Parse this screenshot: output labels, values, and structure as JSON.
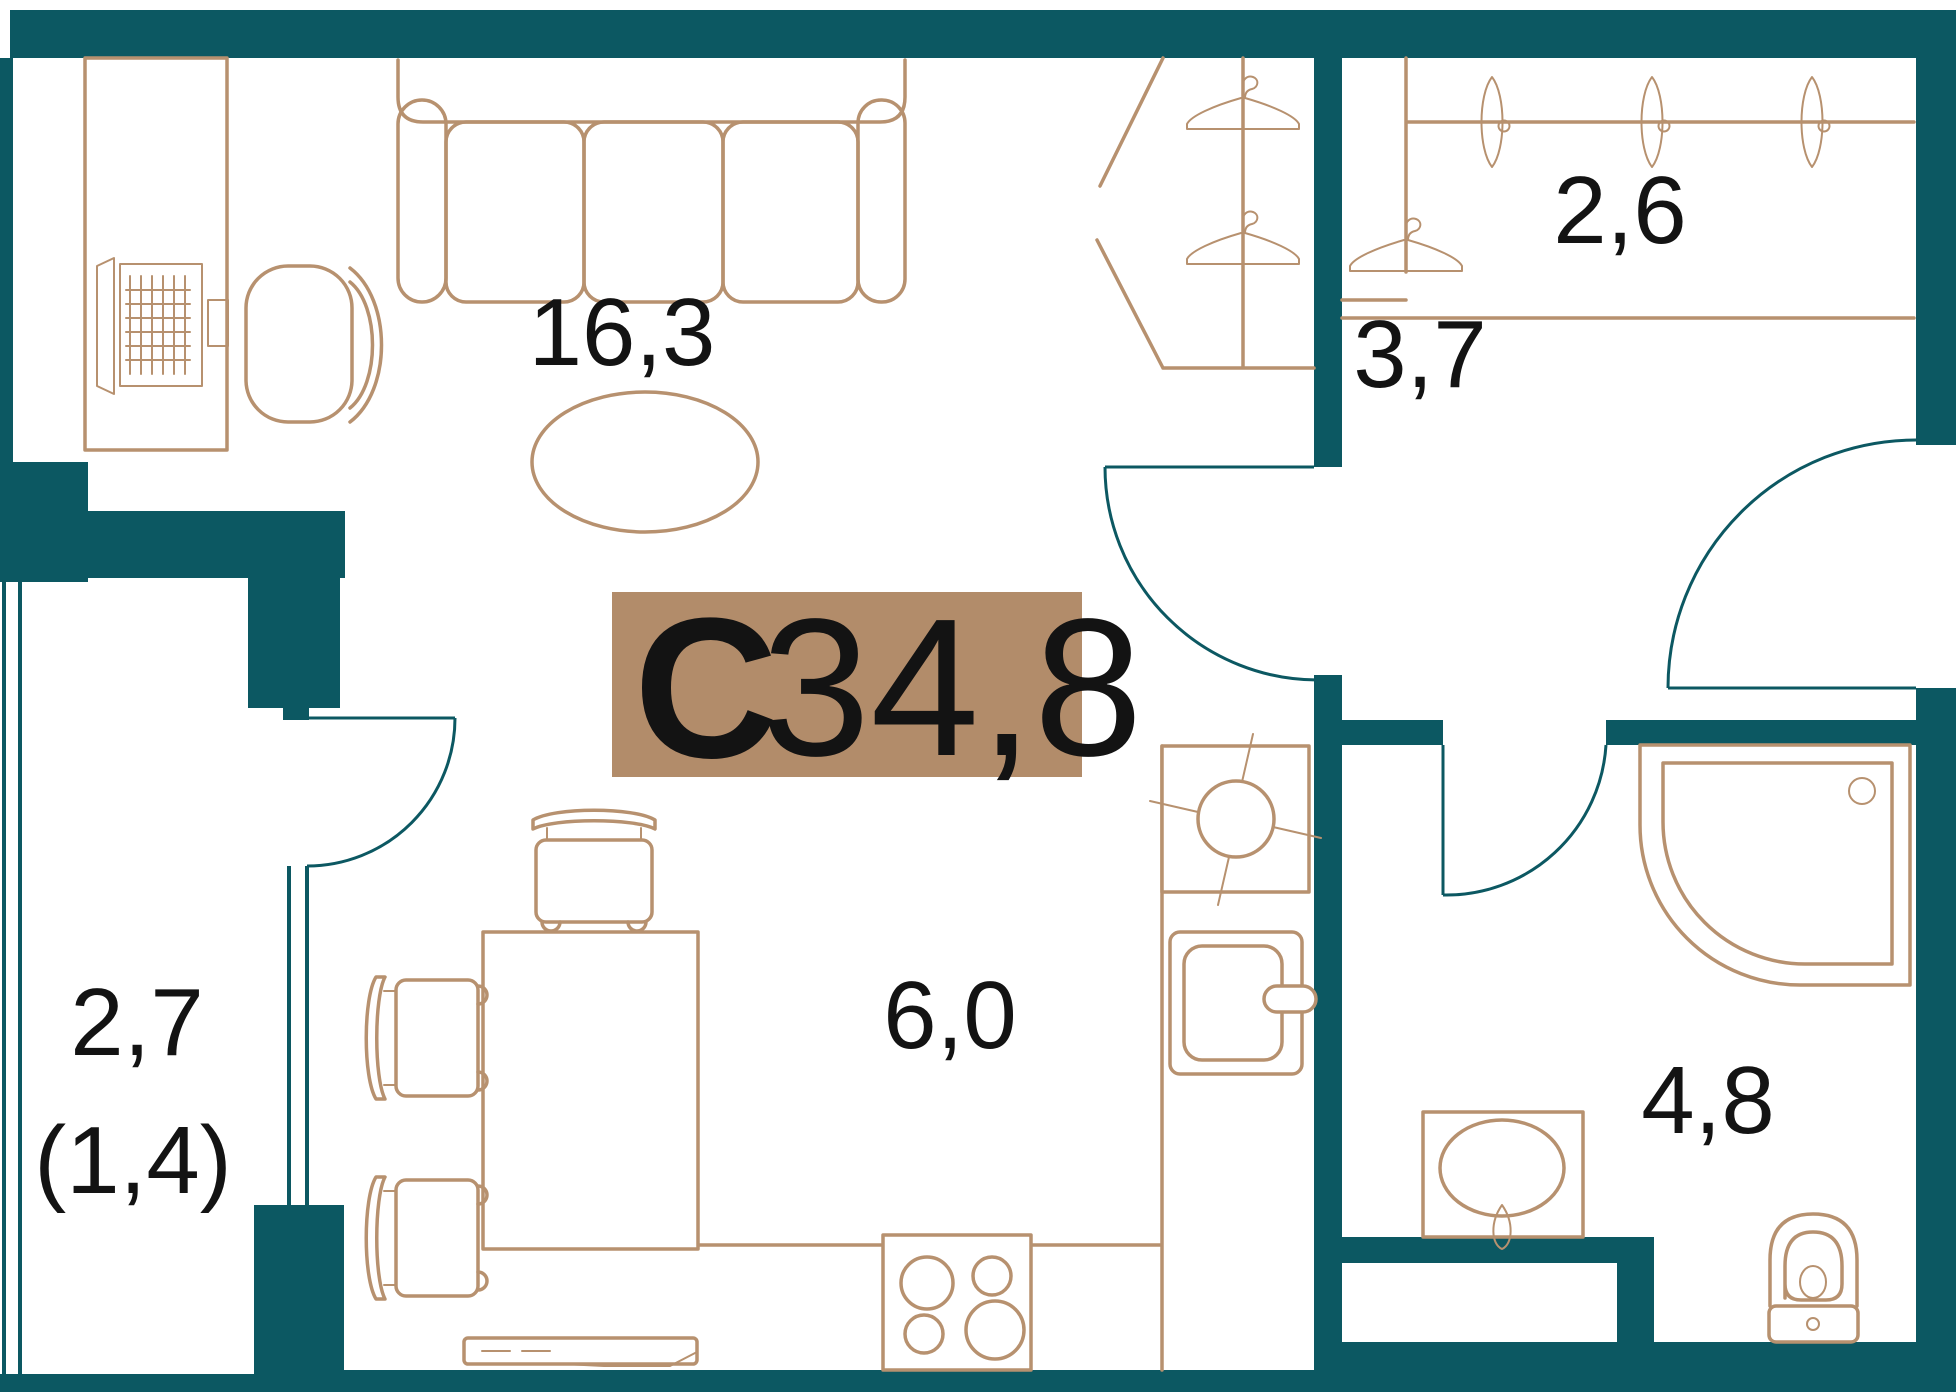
{
  "plan": {
    "labels": {
      "unit_type": "С",
      "total_area": "34,8",
      "living": "16,3",
      "wardrobe": "2,6",
      "hallway": "3,7",
      "kitchen": "6,0",
      "bathroom": "4,8",
      "balcony": "2,7",
      "balcony_reduced": "(1,4)"
    },
    "colors": {
      "wall": "#0c5862",
      "furniture": "#b7916f",
      "badge": "#b28c6a",
      "text": "#131313",
      "background": "#ffffff"
    }
  }
}
